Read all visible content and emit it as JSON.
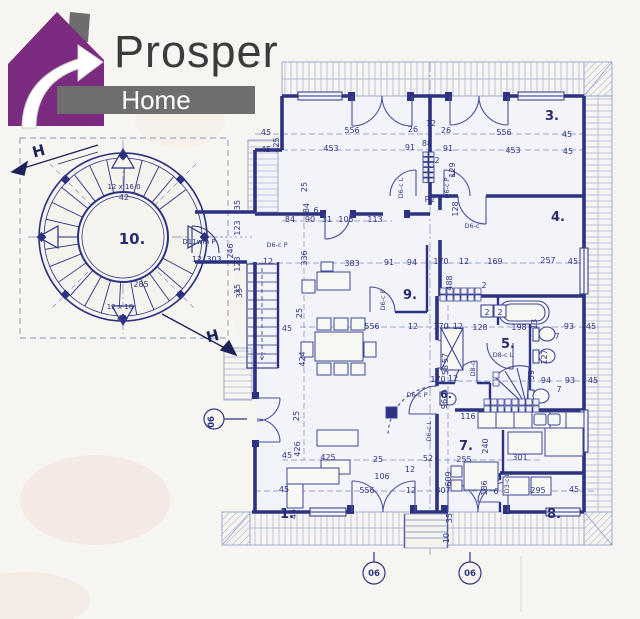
{
  "logo": {
    "brand": "Prosper",
    "sub": "Home",
    "house_color": "#7c2c80",
    "bar_color": "#6f6e6e",
    "text_color": "#3b3b3d"
  },
  "plan": {
    "ink_color": "#2c3280",
    "paper_color": "#f3f4f9",
    "rooms": [
      {
        "t": "1.",
        "x": 287,
        "y": 518
      },
      {
        "t": "3.",
        "x": 552,
        "y": 120
      },
      {
        "t": "4.",
        "x": 558,
        "y": 221
      },
      {
        "t": "5.",
        "x": 508,
        "y": 348
      },
      {
        "t": "6.",
        "x": 446,
        "y": 398,
        "s": 11
      },
      {
        "t": "7.",
        "x": 466,
        "y": 450
      },
      {
        "t": "8.",
        "x": 554,
        "y": 518
      },
      {
        "t": "9.",
        "x": 410,
        "y": 299
      },
      {
        "t": "10.",
        "x": 132,
        "y": 244,
        "s": 15
      }
    ],
    "dims": [
      {
        "t": "45",
        "x": 266,
        "y": 135
      },
      {
        "t": "556",
        "x": 352,
        "y": 133
      },
      {
        "t": "26",
        "x": 413,
        "y": 132
      },
      {
        "t": "12",
        "x": 431,
        "y": 126
      },
      {
        "t": "26",
        "x": 446,
        "y": 133
      },
      {
        "t": "556",
        "x": 504,
        "y": 135
      },
      {
        "t": "45",
        "x": 567,
        "y": 137
      },
      {
        "t": "45",
        "x": 266,
        "y": 152
      },
      {
        "t": "425",
        "x": 279,
        "y": 145,
        "r": -90
      },
      {
        "t": "453",
        "x": 331,
        "y": 151
      },
      {
        "t": "91",
        "x": 410,
        "y": 150
      },
      {
        "t": "88",
        "x": 427,
        "y": 146
      },
      {
        "t": "91",
        "x": 448,
        "y": 151
      },
      {
        "t": "453",
        "x": 513,
        "y": 153
      },
      {
        "t": "45",
        "x": 568,
        "y": 154
      },
      {
        "t": "25",
        "x": 307,
        "y": 187,
        "r": -90
      },
      {
        "t": "84",
        "x": 309,
        "y": 208,
        "r": -90
      },
      {
        "t": "84",
        "x": 290,
        "y": 222
      },
      {
        "t": "90",
        "x": 310,
        "y": 222
      },
      {
        "t": "31",
        "x": 327,
        "y": 222
      },
      {
        "t": "105",
        "x": 346,
        "y": 222
      },
      {
        "t": "113",
        "x": 375,
        "y": 222
      },
      {
        "t": "6",
        "x": 316,
        "y": 213
      },
      {
        "t": "129",
        "x": 455,
        "y": 170,
        "r": -90
      },
      {
        "t": "2",
        "x": 437,
        "y": 163
      },
      {
        "t": "2",
        "x": 453,
        "y": 177
      },
      {
        "t": "35",
        "x": 240,
        "y": 205,
        "r": -90
      },
      {
        "t": "123",
        "x": 240,
        "y": 228,
        "r": -90
      },
      {
        "t": "246",
        "x": 233,
        "y": 251,
        "r": -90
      },
      {
        "t": "123",
        "x": 240,
        "y": 264,
        "r": -90
      },
      {
        "t": "35",
        "x": 240,
        "y": 289,
        "r": -90
      },
      {
        "t": "12",
        "x": 197,
        "y": 262
      },
      {
        "t": "303",
        "x": 214,
        "y": 262
      },
      {
        "t": "12 x 16.0",
        "x": 124,
        "y": 189,
        "s": 7
      },
      {
        "t": "42",
        "x": 124,
        "y": 200
      },
      {
        "t": "285",
        "x": 141,
        "y": 287
      },
      {
        "t": "12 x 18",
        "x": 120,
        "y": 309,
        "s": 7
      },
      {
        "t": "42",
        "x": 122,
        "y": 321
      },
      {
        "t": "12",
        "x": 268,
        "y": 264
      },
      {
        "t": "336",
        "x": 307,
        "y": 258,
        "r": -90
      },
      {
        "t": "383",
        "x": 352,
        "y": 266
      },
      {
        "t": "91",
        "x": 389,
        "y": 265
      },
      {
        "t": "94",
        "x": 412,
        "y": 265
      },
      {
        "t": "170",
        "x": 441,
        "y": 264
      },
      {
        "t": "12",
        "x": 464,
        "y": 264
      },
      {
        "t": "169",
        "x": 495,
        "y": 264
      },
      {
        "t": "257",
        "x": 548,
        "y": 263
      },
      {
        "t": "45",
        "x": 573,
        "y": 264
      },
      {
        "t": "488",
        "x": 452,
        "y": 283,
        "r": -90
      },
      {
        "t": "128",
        "x": 458,
        "y": 209,
        "r": -90
      },
      {
        "t": "556",
        "x": 372,
        "y": 329
      },
      {
        "t": "12",
        "x": 413,
        "y": 329
      },
      {
        "t": "170",
        "x": 441,
        "y": 329
      },
      {
        "t": "12",
        "x": 458,
        "y": 329
      },
      {
        "t": "128",
        "x": 480,
        "y": 330
      },
      {
        "t": "198",
        "x": 519,
        "y": 330
      },
      {
        "t": "13",
        "x": 537,
        "y": 324,
        "r": -90
      },
      {
        "t": "93",
        "x": 569,
        "y": 329
      },
      {
        "t": "45",
        "x": 591,
        "y": 329
      },
      {
        "t": "7",
        "x": 557,
        "y": 339
      },
      {
        "t": "2",
        "x": 484,
        "y": 288
      },
      {
        "t": "2",
        "x": 487,
        "y": 315
      },
      {
        "t": "2",
        "x": 500,
        "y": 315
      },
      {
        "t": "127",
        "x": 547,
        "y": 357,
        "r": -90
      },
      {
        "t": "59",
        "x": 534,
        "y": 375,
        "r": -90
      },
      {
        "t": "57",
        "x": 448,
        "y": 358,
        "r": -90
      },
      {
        "t": "58",
        "x": 448,
        "y": 370,
        "r": -90
      },
      {
        "t": "94",
        "x": 546,
        "y": 383
      },
      {
        "t": "93",
        "x": 570,
        "y": 383
      },
      {
        "t": "45",
        "x": 593,
        "y": 383
      },
      {
        "t": "7",
        "x": 559,
        "y": 392
      },
      {
        "t": "170",
        "x": 438,
        "y": 382
      },
      {
        "t": "12",
        "x": 453,
        "y": 381
      },
      {
        "t": "116",
        "x": 468,
        "y": 419
      },
      {
        "t": "96",
        "x": 447,
        "y": 404,
        "r": -90
      },
      {
        "t": "255",
        "x": 464,
        "y": 462
      },
      {
        "t": "301",
        "x": 520,
        "y": 460
      },
      {
        "t": "240",
        "x": 488,
        "y": 446,
        "r": -90
      },
      {
        "t": "45",
        "x": 284,
        "y": 492
      },
      {
        "t": "556",
        "x": 367,
        "y": 493
      },
      {
        "t": "12",
        "x": 411,
        "y": 493
      },
      {
        "t": "307",
        "x": 443,
        "y": 493
      },
      {
        "t": "609",
        "x": 451,
        "y": 479,
        "r": -90
      },
      {
        "t": "186",
        "x": 487,
        "y": 488,
        "r": -90
      },
      {
        "t": "6",
        "x": 496,
        "y": 494
      },
      {
        "t": "295",
        "x": 538,
        "y": 493
      },
      {
        "t": "45",
        "x": 574,
        "y": 492
      },
      {
        "t": "45",
        "x": 287,
        "y": 458
      },
      {
        "t": "425",
        "x": 328,
        "y": 460
      },
      {
        "t": "25",
        "x": 378,
        "y": 462
      },
      {
        "t": "52",
        "x": 428,
        "y": 461
      },
      {
        "t": "12",
        "x": 410,
        "y": 472
      },
      {
        "t": "106",
        "x": 382,
        "y": 479
      },
      {
        "t": "426",
        "x": 300,
        "y": 449,
        "r": -90
      },
      {
        "t": "25",
        "x": 299,
        "y": 416,
        "r": -90
      },
      {
        "t": "424",
        "x": 305,
        "y": 359,
        "r": -90
      },
      {
        "t": "45",
        "x": 287,
        "y": 331
      },
      {
        "t": "25",
        "x": 302,
        "y": 313,
        "r": -90
      },
      {
        "t": "35",
        "x": 242,
        "y": 293,
        "r": -90
      },
      {
        "t": "45",
        "x": 296,
        "y": 514,
        "r": -90
      },
      {
        "t": "35",
        "x": 452,
        "y": 518,
        "r": -90
      },
      {
        "t": "10",
        "x": 449,
        "y": 538,
        "r": -90
      }
    ],
    "doors": [
      {
        "t": "D6-c P",
        "x": 277,
        "y": 247
      },
      {
        "t": "D6-c L",
        "x": 403,
        "y": 188,
        "r": -90
      },
      {
        "t": "D6-c P",
        "x": 449,
        "y": 188,
        "r": -90
      },
      {
        "t": "R2",
        "x": 430,
        "y": 202,
        "s": 8
      },
      {
        "t": "D6-c",
        "x": 472,
        "y": 228
      },
      {
        "t": "D6-c P",
        "x": 385,
        "y": 300,
        "r": -90
      },
      {
        "t": "D8-c L",
        "x": 503,
        "y": 357
      },
      {
        "t": "D8-c",
        "x": 475,
        "y": 369,
        "r": -90
      },
      {
        "t": "D6-c L",
        "x": 431,
        "y": 431,
        "r": -90
      },
      {
        "t": "D6-c P",
        "x": 417,
        "y": 397
      },
      {
        "t": "D3-c L",
        "x": 509,
        "y": 483,
        "r": -90
      },
      {
        "t": "D11wm P",
        "x": 199,
        "y": 244,
        "s": 7
      }
    ],
    "marks": [
      {
        "t": "H",
        "x": 40,
        "y": 156,
        "r": -15
      },
      {
        "t": "H",
        "x": 214,
        "y": 341,
        "r": -15
      }
    ],
    "refs": [
      {
        "t": "06",
        "x": 374,
        "y": 576
      },
      {
        "t": "06",
        "x": 470,
        "y": 576
      },
      {
        "t": "06",
        "x": 214,
        "y": 422,
        "r": -90
      }
    ]
  }
}
